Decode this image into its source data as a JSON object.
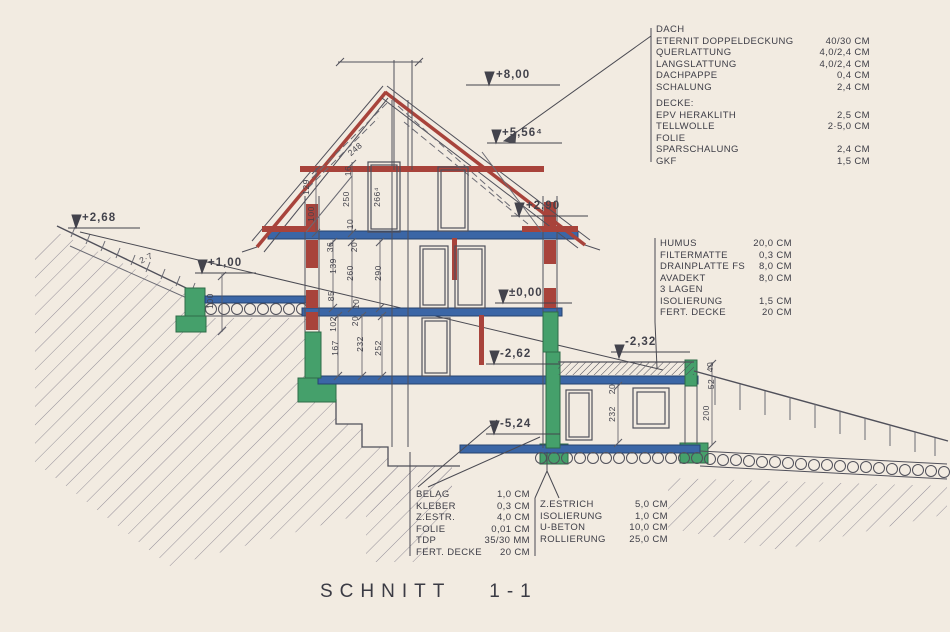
{
  "title": "SCHNITT 1-1",
  "colors": {
    "paper": "#f2ebe1",
    "line": "#50505a",
    "red": "#a8433b",
    "blue": "#3b66a6",
    "green": "#45a06b"
  },
  "specs": {
    "roof": {
      "heading": "DACH",
      "rows": [
        {
          "label": "ETERNIT DOPPELDECKUNG",
          "value": "40/30 CM"
        },
        {
          "label": "QUERLATTUNG",
          "value": "4,0/2,4 CM"
        },
        {
          "label": "LANGSLATTUNG",
          "value": "4,0/2,4 CM"
        },
        {
          "label": "DACHPAPPE",
          "value": "0,4 CM"
        },
        {
          "label": "SCHALUNG",
          "value": "2,4 CM"
        }
      ]
    },
    "ceiling": {
      "heading": "DECKE:",
      "rows": [
        {
          "label": "EPV HERAKLITH",
          "value": "2,5 CM"
        },
        {
          "label": "TELLWOLLE",
          "value": "2·5,0 CM"
        },
        {
          "label": "FOLIE",
          "value": ""
        },
        {
          "label": "SPARSCHALUNG",
          "value": "2,4 CM"
        },
        {
          "label": "GKF",
          "value": "1,5 CM"
        }
      ]
    },
    "terrace": {
      "rows": [
        {
          "label": "HUMUS",
          "value": "20,0 CM"
        },
        {
          "label": "FILTERMATTE",
          "value": "0,3 CM"
        },
        {
          "label": "DRAINPLATTE FS",
          "value": "8,0 CM"
        },
        {
          "label": "AVADEKT",
          "value": "8,0 CM"
        },
        {
          "label": "3 LAGEN",
          "value": ""
        },
        {
          "label": "ISOLIERUNG",
          "value": "1,5 CM"
        },
        {
          "label": "FERT. DECKE",
          "value": "20 CM"
        }
      ]
    },
    "floor_interior": {
      "rows": [
        {
          "label": "BELAG",
          "value": "1,0 CM"
        },
        {
          "label": "KLEBER",
          "value": "0,3 CM"
        },
        {
          "label": "Z.ESTR.",
          "value": "4,0 CM"
        },
        {
          "label": "FOLIE",
          "value": "0,01 CM"
        },
        {
          "label": "TDP",
          "value": "35/30 MM"
        },
        {
          "label": "FERT. DECKE",
          "value": "20 CM"
        }
      ]
    },
    "floor_basement": {
      "rows": [
        {
          "label": "Z.ESTRICH",
          "value": "5,0 CM"
        },
        {
          "label": "ISOLIERUNG",
          "value": "1,0 CM"
        },
        {
          "label": "U-BETON",
          "value": "10,0 CM"
        },
        {
          "label": "ROLLIERUNG",
          "value": "25,0 CM"
        }
      ]
    }
  },
  "elevations": {
    "e800": "+8,00",
    "e556": "+5,56⁴",
    "e290": "+2,90",
    "e268": "+2,68",
    "e100": "+1,00",
    "e000": "±0,00",
    "em262": "-2,62",
    "em232": "-2,32",
    "em524": "-5,24"
  },
  "dims": {
    "v248": "248",
    "v129": "129",
    "v100": "100",
    "v16": "16",
    "v250": "250",
    "v10": "10",
    "v266": "266⁴",
    "v36": "36",
    "v20": "20",
    "v139": "139",
    "v260": "260",
    "v290": "290",
    "v85": "85",
    "v102": "102",
    "v167": "167",
    "v232": "232",
    "v252": "252",
    "v200": "200",
    "v40": "40",
    "v52": "52",
    "v27": "2·7"
  }
}
